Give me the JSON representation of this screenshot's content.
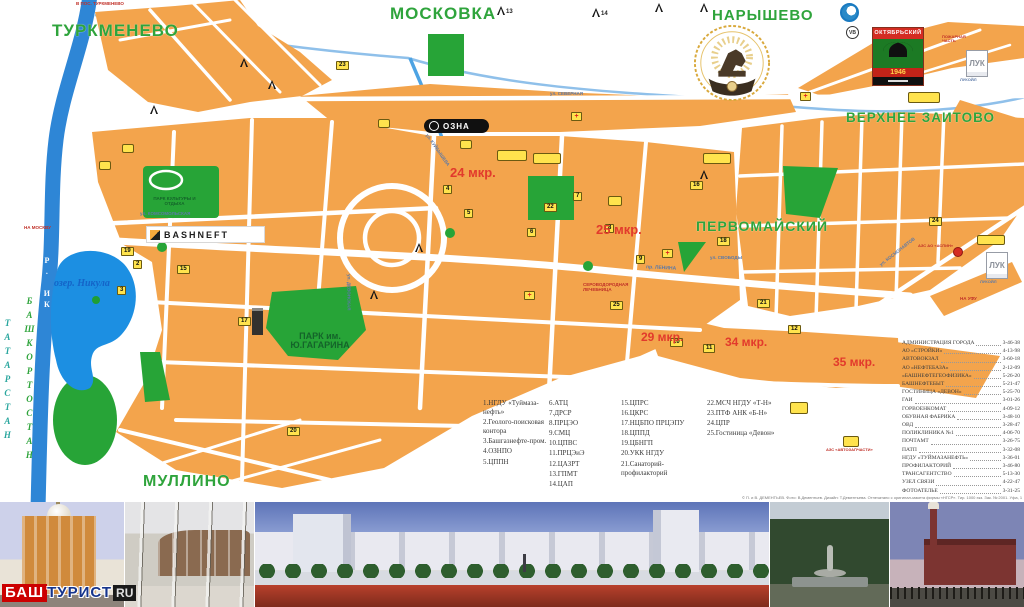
{
  "map": {
    "logos": {
      "bashneft": "BASHNEFT",
      "ozna": "ОЗНА",
      "luk": "ЛУК",
      "vb": "VB",
      "sign_title": "ОКТЯБРЬСКИЙ",
      "sign_year": "1946"
    },
    "labels": [
      {
        "t": "ТУРКМЕНЕВО",
        "x": 52,
        "y": 22,
        "c": "district",
        "fs": 17
      },
      {
        "t": "МОСКОВКА",
        "x": 390,
        "y": 5,
        "c": "district",
        "fs": 17
      },
      {
        "t": "НАРЫШЕВО",
        "x": 712,
        "y": 8,
        "c": "district",
        "fs": 15
      },
      {
        "t": "ВЕРХНЕЕ ЗАИТОВО",
        "x": 846,
        "y": 111,
        "c": "district",
        "fs": 13.5
      },
      {
        "t": "ПЕРВОМАЙСКИЙ",
        "x": 696,
        "y": 219,
        "c": "district",
        "fs": 14
      },
      {
        "t": "МУЛЛИНО",
        "x": 143,
        "y": 474,
        "c": "district",
        "fs": 16
      },
      {
        "t": "ПАРК им. Ю.ГАГАРИНА",
        "x": 280,
        "y": 332,
        "c": "park",
        "fs": 9,
        "w": 80
      },
      {
        "t": "ПАРК КУЛЬТУРЫ И ОТДЫХА",
        "x": 147,
        "y": 197,
        "c": "parksm",
        "fs": 4.5,
        "w": 55
      },
      {
        "t": "24 мкр.",
        "x": 450,
        "y": 166,
        "c": "micro",
        "fs": 13
      },
      {
        "t": "25 мкр.",
        "x": 596,
        "y": 223,
        "c": "micro",
        "fs": 13
      },
      {
        "t": "29 мкр.",
        "x": 641,
        "y": 331,
        "c": "micro",
        "fs": 12
      },
      {
        "t": "34 мкр.",
        "x": 725,
        "y": 336,
        "c": "micro",
        "fs": 12
      },
      {
        "t": "35 мкр.",
        "x": 833,
        "y": 356,
        "c": "micro",
        "fs": 12
      },
      {
        "t": "озер. Никула",
        "x": 54,
        "y": 279,
        "c": "water",
        "fs": 10
      },
      {
        "t": "Р. ИК",
        "x": 42,
        "y": 256,
        "c": "riverv",
        "fs": 8
      },
      {
        "t": "ТАТАРСТАН",
        "x": 2,
        "y": 318,
        "c": "tat",
        "fs": 9
      },
      {
        "t": "БАШКОРТОСТАН",
        "x": 24,
        "y": 296,
        "c": "bash",
        "fs": 9
      },
      {
        "t": "В ПОС. ТУРКМЕНЕВО",
        "x": 76,
        "y": 2,
        "c": "red",
        "fs": 4.5
      },
      {
        "t": "НА МОСКВУ",
        "x": 24,
        "y": 226,
        "c": "red",
        "fs": 4.5
      },
      {
        "t": "НА УФУ",
        "x": 960,
        "y": 297,
        "c": "red",
        "fs": 4.5
      },
      {
        "t": "ПОЖАРНАЯ ЧАСТЬ",
        "x": 942,
        "y": 35,
        "c": "red",
        "fs": 4,
        "w": 36
      },
      {
        "t": "СЕРОВОДОРОДНАЯ ЛЕЧЕБНИЦА",
        "x": 583,
        "y": 283,
        "c": "red",
        "fs": 4.5,
        "w": 52
      },
      {
        "t": "АЗС АО «АСПИН»",
        "x": 918,
        "y": 244,
        "c": "red",
        "fs": 4
      },
      {
        "t": "АЗС «АВТОЗАПЧАСТИ»",
        "x": 826,
        "y": 448,
        "c": "red",
        "fs": 4
      },
      {
        "t": "ул. СЕВЕРНАЯ",
        "x": 550,
        "y": 92,
        "c": "street",
        "fs": 4.5
      },
      {
        "t": "ул. КОМСОМОЛЬСКАЯ",
        "x": 140,
        "y": 212,
        "c": "street",
        "fs": 4.5
      },
      {
        "t": "пр. ЛЕНИНА",
        "x": 646,
        "y": 266,
        "c": "street",
        "fs": 5,
        "rot": 3
      },
      {
        "t": "ул. СВОБОДЫ",
        "x": 710,
        "y": 256,
        "c": "street",
        "fs": 4.5
      },
      {
        "t": "ул. КОСМОНАВТОВ",
        "x": 876,
        "y": 250,
        "c": "street",
        "fs": 4.5,
        "rot": -38
      },
      {
        "t": "ул. КУЙБЫШЕВА",
        "x": 418,
        "y": 148,
        "c": "street",
        "fs": 4.5,
        "rot": 55
      },
      {
        "t": "ул. ДЕВОНСКАЯ",
        "x": 330,
        "y": 290,
        "c": "street",
        "fs": 4.5,
        "rot": 90
      },
      {
        "t": "ЛУКОЙЛ",
        "x": 960,
        "y": 78,
        "c": "street",
        "fs": 4
      },
      {
        "t": "ЛУКОЙЛ",
        "x": 980,
        "y": 280,
        "c": "street",
        "fs": 4
      }
    ],
    "badges": [
      {
        "n": "1",
        "x": 150,
        "y": 229
      },
      {
        "n": "2",
        "x": 133,
        "y": 260
      },
      {
        "n": "3",
        "x": 117,
        "y": 286
      },
      {
        "n": "4",
        "x": 443,
        "y": 185
      },
      {
        "n": "5",
        "x": 464,
        "y": 209
      },
      {
        "n": "6",
        "x": 527,
        "y": 228
      },
      {
        "n": "7",
        "x": 573,
        "y": 192
      },
      {
        "n": "8",
        "x": 605,
        "y": 224
      },
      {
        "n": "9",
        "x": 636,
        "y": 255
      },
      {
        "n": "10",
        "x": 670,
        "y": 338
      },
      {
        "n": "11",
        "x": 703,
        "y": 344
      },
      {
        "n": "12",
        "x": 788,
        "y": 325
      },
      {
        "n": "15",
        "x": 177,
        "y": 265
      },
      {
        "n": "16",
        "x": 690,
        "y": 181
      },
      {
        "n": "17",
        "x": 238,
        "y": 317
      },
      {
        "n": "18",
        "x": 717,
        "y": 237
      },
      {
        "n": "19",
        "x": 121,
        "y": 247
      },
      {
        "n": "20",
        "x": 287,
        "y": 427
      },
      {
        "n": "21",
        "x": 757,
        "y": 299
      },
      {
        "n": "22",
        "x": 544,
        "y": 203
      },
      {
        "n": "23",
        "x": 336,
        "y": 61
      },
      {
        "n": "24",
        "x": 929,
        "y": 217
      },
      {
        "n": "25",
        "x": 610,
        "y": 301
      }
    ],
    "crosses": [
      {
        "x": 697,
        "y": 59
      },
      {
        "x": 524,
        "y": 291
      },
      {
        "x": 662,
        "y": 249
      },
      {
        "x": 800,
        "y": 92
      },
      {
        "x": 571,
        "y": 112
      }
    ],
    "derricks": [
      {
        "n": "13",
        "x": 497,
        "y": 6
      },
      {
        "n": "14",
        "x": 592,
        "y": 8
      },
      {
        "n": "",
        "x": 655,
        "y": 3
      },
      {
        "n": "",
        "x": 700,
        "y": 3
      },
      {
        "n": "",
        "x": 240,
        "y": 58
      },
      {
        "n": "",
        "x": 268,
        "y": 80
      },
      {
        "n": "",
        "x": 150,
        "y": 105
      },
      {
        "n": "",
        "x": 415,
        "y": 243
      },
      {
        "n": "",
        "x": 370,
        "y": 290
      },
      {
        "n": "",
        "x": 700,
        "y": 170
      }
    ],
    "yboxes": [
      [
        378,
        119,
        10,
        7
      ],
      [
        99,
        161,
        10,
        7
      ],
      [
        122,
        144,
        10,
        7
      ],
      [
        497,
        150,
        28,
        9
      ],
      [
        533,
        153,
        26,
        9
      ],
      [
        703,
        153,
        26,
        9
      ],
      [
        977,
        235,
        26,
        8
      ],
      [
        908,
        92,
        30,
        9
      ],
      [
        843,
        436,
        14,
        9
      ],
      [
        790,
        402,
        16,
        10
      ],
      [
        460,
        140,
        10,
        7
      ],
      [
        608,
        196,
        12,
        8
      ]
    ]
  },
  "legend": {
    "columns": [
      [
        "1.НГДУ «Туймаза-нефть»",
        "2.Геолого-поисковая контора",
        "3.Башгазнефте-пром.",
        "4.ОЗНПО",
        "5.ЦППН"
      ],
      [
        "6.АТЦ",
        "7.ДРСР",
        "8.ПРЦЭО",
        "9.СМЦ",
        "10.ЦПВС",
        "11.ПРЦЭиЭ",
        "12.ЦАЗРТ",
        "13.ГПМТ",
        "14.ЦАП"
      ],
      [
        "15.ЦПРС",
        "16.ЦКРС",
        "17.НЦБПО ПРЦЭПУ",
        "18.ЦППД",
        "19.ЦБНГП",
        "20.УКК НГДУ",
        "21.Санаторий-профилакторий"
      ],
      [
        "22.МСЧ НГДУ «Т-Н»",
        "23.ПТФ АНК «Б-Н»",
        "24.ЦПР",
        "25.Гостиница «Девон»"
      ]
    ]
  },
  "directory": {
    "entries": [
      [
        "АДМИНИСТРАЦИЯ ГОРОДА",
        "3-46-38"
      ],
      [
        "АО «СТРОЙКИ»",
        "4-13-98"
      ],
      [
        "АВТОВОКЗАЛ",
        "3-60-18"
      ],
      [
        "АО «НЕФТЕБАЗА»",
        "2-12-09"
      ],
      [
        "«БАШНЕФТЕГЕОФИЗИКА»",
        "5-26-20"
      ],
      [
        "БАШНЕФТЕБЫТ",
        "5-21-47"
      ],
      [
        "ГОСТИНИЦА «ДЕВОН»",
        "5-25-70"
      ],
      [
        "ГАИ",
        "3-01-26"
      ],
      [
        "ГОРВОЕНКОМАТ",
        "4-09-12"
      ],
      [
        "ОБУВНАЯ ФАБРИКА",
        "3-48-10"
      ],
      [
        "ОВД",
        "3-28-47"
      ],
      [
        "ПОЛИКЛИНИКА №1",
        "4-06-70"
      ],
      [
        "ПОЧТАМТ",
        "3-26-75"
      ],
      [
        "ПАТП",
        "3-32-08"
      ],
      [
        "НГДУ «ТУЙМАЗАНЕФТЬ»",
        "3-36-01"
      ],
      [
        "ПРОФИЛАКТОРИЙ",
        "3-46-80"
      ],
      [
        "ТРАНСАГЕНТСТВО",
        "5-13-30"
      ],
      [
        "УЗЕЛ СВЯЗИ",
        "4-22-47"
      ],
      [
        "ФОТОАТЕЛЬЕ",
        "3-31-25"
      ]
    ]
  },
  "copyright": "© П. и В. ДЕМЕНТЬЕВ. Фото: В.Дементьев. Дизайн: Т.Дементьева. Отпечатано с оригинал-макета фирмы «НГСР». Тир. 1000 экз. Зак. № 2001. Уфа, 1997 г.",
  "branding": {
    "bash": "БАШ",
    "turist": "ТУРИСТ",
    "ru": "RU"
  }
}
